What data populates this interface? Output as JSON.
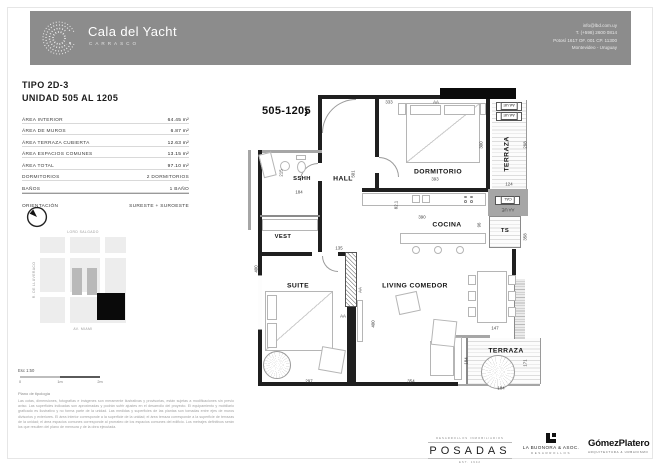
{
  "header": {
    "brand": "Cala del Yacht",
    "brand_sub": "CARRASCO",
    "contact": [
      "info@lbd.com.uy",
      "T. (+598) 2600 0814",
      "Potosí 1617 OF. 001 CP. 11300",
      "Montevideo - Uruguay"
    ]
  },
  "info": {
    "tipo": "TIPO 2D-3",
    "unidad": "UNIDAD 505 AL 1205",
    "areas": [
      {
        "label": "ÁREA INTERIOR",
        "value": "64.45 m²"
      },
      {
        "label": "ÁREA DE MUROS",
        "value": "6.87 m²"
      },
      {
        "label": "ÁREA TERRAZA CUBIERTA",
        "value": "12.63 m²"
      },
      {
        "label": "ÁREA ESPACIOS COMUNES",
        "value": "13.15 m²"
      },
      {
        "label": "ÁREA TOTAL",
        "value": "97.10 m²"
      }
    ],
    "details": [
      {
        "label": "DORMITORIOS",
        "value": "2 DORMITORIOS"
      },
      {
        "label": "BAÑOS",
        "value": "1 BAÑO"
      },
      {
        "label": "ORIENTACIÓN",
        "value": "SURESTE + SUROESTE"
      }
    ],
    "map": {
      "street_top": "LORD SALGADO",
      "street_left": "R. DE LLUVERACO",
      "street_bottom": "AV. MIAMI"
    }
  },
  "plan": {
    "unit_tag": "505-1205",
    "unit_tag_arrow": "›",
    "annotations": [
      {
        "t": "SSHH",
        "x": 54,
        "y": 94,
        "c": "room s"
      },
      {
        "t": "HALL",
        "x": 95,
        "y": 94,
        "c": "room"
      },
      {
        "t": "DORMITORIO",
        "x": 190,
        "y": 87,
        "c": "room"
      },
      {
        "t": "COCINA",
        "x": 199,
        "y": 140,
        "c": "room"
      },
      {
        "t": "VEST",
        "x": 35,
        "y": 152,
        "c": "room s"
      },
      {
        "t": "SUITE",
        "x": 50,
        "y": 201,
        "c": "room"
      },
      {
        "t": "LIVING COMEDOR",
        "x": 167,
        "y": 201,
        "c": "room"
      },
      {
        "t": "TERRAZA",
        "x": 259,
        "y": 69,
        "c": "room v"
      },
      {
        "t": "TERRAZA",
        "x": 258,
        "y": 266,
        "c": "room"
      },
      {
        "t": "TS",
        "x": 257,
        "y": 146,
        "c": "room s"
      },
      {
        "t": "333",
        "x": 141,
        "y": 17,
        "c": "dim"
      },
      {
        "t": "AA",
        "x": 188,
        "y": 17,
        "c": "dim"
      },
      {
        "t": "215",
        "x": 33,
        "y": 88,
        "c": "dim v"
      },
      {
        "t": "184",
        "x": 51,
        "y": 107,
        "c": "dim"
      },
      {
        "t": "501",
        "x": 105,
        "y": 89,
        "c": "dim v"
      },
      {
        "t": "393",
        "x": 187,
        "y": 94,
        "c": "dim"
      },
      {
        "t": "82.1",
        "x": 148,
        "y": 120,
        "c": "dim v"
      },
      {
        "t": "390",
        "x": 174,
        "y": 132,
        "c": "dim"
      },
      {
        "t": "96",
        "x": 231,
        "y": 140,
        "c": "dim v"
      },
      {
        "t": "300",
        "x": 233,
        "y": 60,
        "c": "dim v"
      },
      {
        "t": "298",
        "x": 277,
        "y": 60,
        "c": "dim v"
      },
      {
        "t": "124",
        "x": 261,
        "y": 99,
        "c": "dim"
      },
      {
        "t": "358",
        "x": 277,
        "y": 152,
        "c": "dim v"
      },
      {
        "t": "135",
        "x": 91,
        "y": 163,
        "c": "dim"
      },
      {
        "t": "400",
        "x": 8,
        "y": 184,
        "c": "dim v"
      },
      {
        "t": "AA",
        "x": 112,
        "y": 205,
        "c": "dim v"
      },
      {
        "t": "AA",
        "x": 95,
        "y": 231,
        "c": "dim"
      },
      {
        "t": "400",
        "x": 125,
        "y": 239,
        "c": "dim v"
      },
      {
        "t": "297",
        "x": 61,
        "y": 296,
        "c": "dim"
      },
      {
        "t": "354",
        "x": 163,
        "y": 296,
        "c": "dim"
      },
      {
        "t": "184",
        "x": 218,
        "y": 276,
        "c": "dim v"
      },
      {
        "t": "147",
        "x": 247,
        "y": 243,
        "c": "dim"
      },
      {
        "t": "171",
        "x": 277,
        "y": 278,
        "c": "dim v"
      },
      {
        "t": "184",
        "x": 253,
        "y": 303,
        "c": "dim"
      },
      {
        "t": "AA UE",
        "x": 261,
        "y": 21,
        "c": "boxr"
      },
      {
        "t": "AA UE",
        "x": 261,
        "y": 31,
        "c": "boxr"
      },
      {
        "t": "CAL",
        "x": 260,
        "y": 115,
        "c": "boxr"
      },
      {
        "t": "AA UE",
        "x": 260,
        "y": 125,
        "c": "dim r"
      }
    ]
  },
  "footer": {
    "scale_label": "Esc 1:50",
    "scale_ticks": [
      "0",
      "1m",
      "2m"
    ],
    "caption": "Plano de tipología",
    "disclaimer": [
      "Las cotas, dimensiones, fotografías e imágenes son meramente ilustrativas y provisorias, están sujetas a",
      "modificaciones sin previo aviso. Las superficies indicadas son aproximadas y podrán sufrir ajustes en el",
      "desarrollo del proyecto. El equipamiento y mobiliario graficado es ilustrativo y no forma parte de la unidad.",
      "Las medidas y superficies de las plantas son tomadas entre ejes de muros divisorios y exteriores. El área",
      "interior corresponde a la superficie de la unidad; el área terraza corresponde a la superficie de terrazas de",
      "la unidad; el área espacios comunes corresponde al prorrateo de los espacios comunes del edificio. Los",
      "metrajes definitivos serán los que resulten del plano de mensura y de la obra ejecutada."
    ],
    "logos": {
      "posadas_top": "DESARROLLOS INMOBILIARIOS",
      "posadas": "POSADAS",
      "posadas_bottom": "EST. 1942",
      "buonora": "LA BUONORA & ASOC.",
      "buonora_sub": "DESARROLLOS",
      "gomez": "GómezPlatero",
      "gomez_sub": "ARQUITECTURA & URBANISMO"
    }
  }
}
